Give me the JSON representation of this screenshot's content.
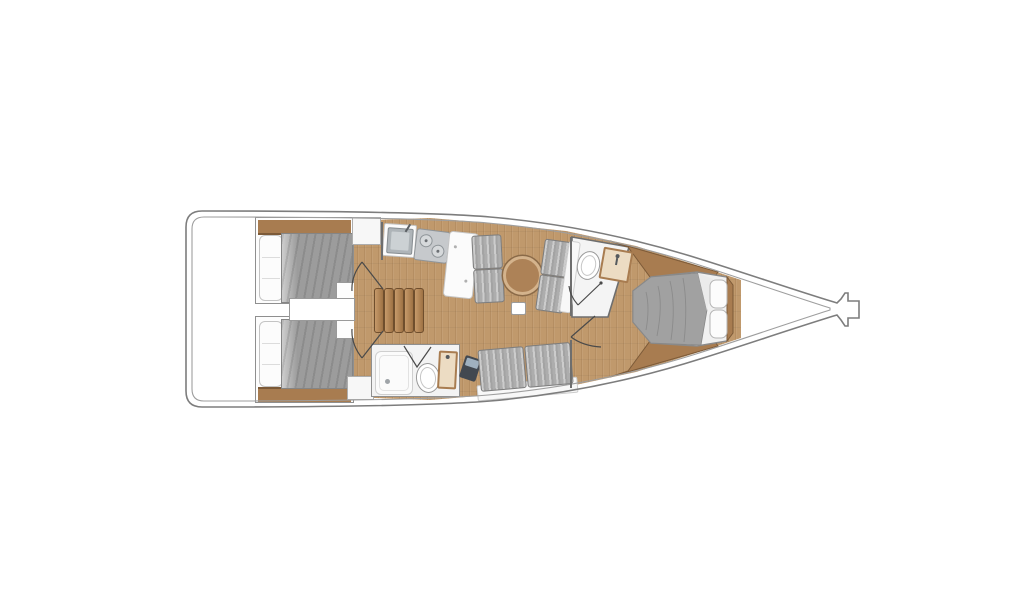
{
  "diagram": {
    "kind": "sailing-yacht-interior-floor-plan",
    "view": "top-down",
    "orientation": {
      "stern": "left",
      "bow": "right"
    },
    "rooms": [
      {
        "id": "aft-cabin-port"
      },
      {
        "id": "aft-cabin-starboard"
      },
      {
        "id": "companionway-steps"
      },
      {
        "id": "galley"
      },
      {
        "id": "salon"
      },
      {
        "id": "aft-head"
      },
      {
        "id": "forward-head"
      },
      {
        "id": "forward-cabin"
      }
    ],
    "fixtures": [
      "double-berth-port",
      "double-berth-starboard",
      "galley-sink",
      "galley-stove",
      "galley-counter",
      "salon-settee-port",
      "salon-settee-forward",
      "salon-round-table",
      "salon-settee-starboard",
      "nav-laptop",
      "aft-shower",
      "aft-toilet",
      "aft-vanity",
      "forward-toilet",
      "forward-vanity",
      "v-berth",
      "bow-sprit",
      "floor-hatch"
    ]
  },
  "colors": {
    "hull_outline": "#7d7d7d",
    "hull_inner": "#9e9e9e",
    "wood_floor": "#c0996c",
    "wood_dark": "#a87c50",
    "wood_trim": "#7c5a38",
    "step_wood_light": "#c79a6a",
    "step_wood_dark": "#9e7244",
    "step_edge": "#6f4e2d",
    "mattress_gray": "#9c9c9c",
    "blanket_gray": "#a1a1a1",
    "cushion_gray": "#adadad",
    "pillow_white": "#fcfcfc",
    "wall_gray": "#6e6e6e",
    "surface_white": "#f7f7f7",
    "sink_steel": "#aeb4b8",
    "stove_gray": "#c6c9cc",
    "vanity_beige": "#ecdcc3",
    "device_dark": "#424850",
    "table_wood": "#ad8257",
    "table_ring": "#d4b38c",
    "arc_line": "#4a4a4a"
  }
}
